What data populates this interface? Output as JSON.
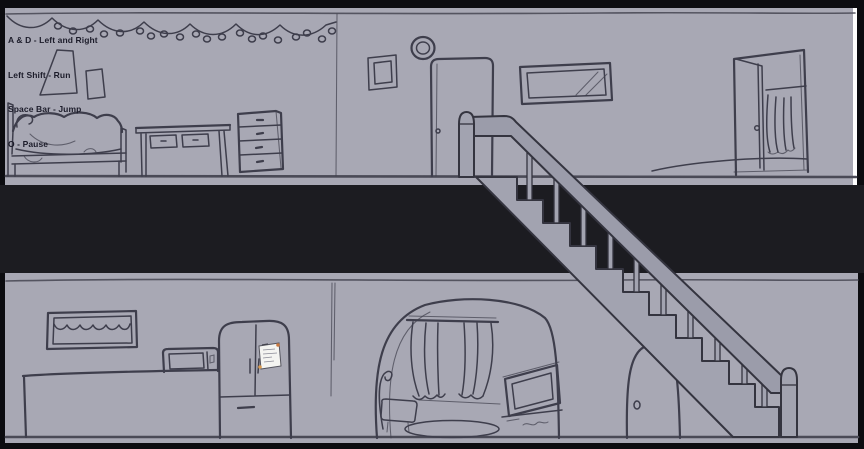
{
  "game": {
    "controls_hud": {
      "lines": [
        "A & D - Left and Right",
        "Left Shift - Run",
        "Space Bar - Jump",
        "O - Pause"
      ]
    },
    "colors": {
      "background": "#0c0c10",
      "gap_band": "#1c1c21",
      "wall": "#a8a8b4",
      "outline": "#3e3e4c",
      "floor_line": "#4a4a56",
      "stair_fill": "#a2a3b0",
      "rail_fill": "#9b9caa",
      "stair_outline": "#34343f",
      "note_paper": "#f4f4f1",
      "note_pin": "#c87840",
      "hud_text": "#1c1c2a",
      "highlight_strip": "#ffffff"
    },
    "scene": {
      "upper_floor_objects": [
        "string-lights",
        "wall-posters",
        "bed",
        "desk",
        "dresser",
        "wall-divider",
        "picture-frame",
        "wall-clock",
        "bedroom-door",
        "window",
        "open-closet-door"
      ],
      "lower_floor_objects": [
        "kitchen-window-valance",
        "counter",
        "microwave",
        "fridge",
        "fridge-note",
        "archway",
        "curtained-window",
        "armchair-ottoman",
        "tv-on-stand",
        "rug",
        "round-top-door"
      ],
      "staircase_parts": [
        "upper-newel-post",
        "handrail",
        "balusters",
        "steps",
        "lower-newel-post"
      ]
    }
  }
}
